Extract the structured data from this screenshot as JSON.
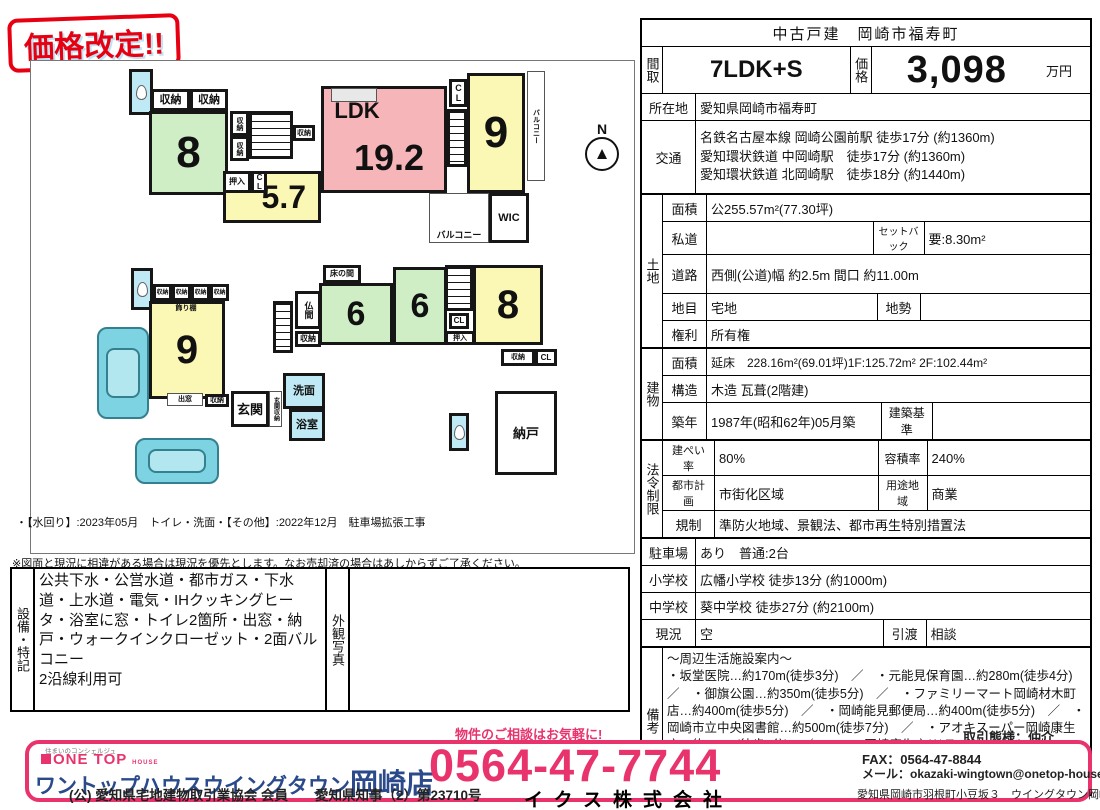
{
  "badge": {
    "label": "価格改定!!"
  },
  "notes": {
    "renovation": "・【水回り】:2023年05月　トイレ・洗面・【その他】:2022年12月　駐車場拡張工事",
    "disclaimer": "※図面と現況に相違がある場合は現況を優先とします。なお売却済の場合はあしからずご了承ください。"
  },
  "equipment": {
    "section": "設備・特記",
    "text": "公共下水・公営水道・都市ガス・下水道・上水道・電気・IHクッキングヒータ・浴室に窓・トイレ2箇所・出窓・納戸・ウォークインクローゼット・2面バルコニー\n2沿線利用可",
    "photo_label": "外観写真"
  },
  "spec": {
    "title": "中古戸建　岡崎市福寿町",
    "floor_label": "間取",
    "floor": "7LDK+S",
    "price_label": "価格",
    "price": "3,098",
    "price_unit": "万円",
    "location_label": "所在地",
    "location": "愛知県岡崎市福寿町",
    "transport_label": "交通",
    "transport": "名鉄名古屋本線 岡崎公園前駅 徒歩17分 (約1360m)\n愛知環状鉄道 中岡崎駅　徒歩17分 (約1360m)\n愛知環状鉄道 北岡崎駅　徒歩18分 (約1440m)",
    "land": {
      "section": "土地",
      "area_label": "面積",
      "area": "公255.57m²(77.30坪)",
      "shido_label": "私道",
      "shido": "",
      "setback_label": "セットバック",
      "setback": "要:8.30m²",
      "road_label": "道路",
      "road": "西側(公道)幅 約2.5m 間口 約11.00m",
      "chimoku_label": "地目",
      "chimoku": "宅地",
      "chisei_label": "地勢",
      "chisei": "",
      "rights_label": "権利",
      "rights": "所有権"
    },
    "building": {
      "section": "建物",
      "area_label": "面積",
      "area": "延床　228.16m²(69.01坪)1F:125.72m² 2F:102.44m²",
      "structure_label": "構造",
      "structure": "木造 瓦葺(2階建)",
      "built_label": "築年",
      "built": "1987年(昭和62年)05月築",
      "standard_label": "建築基準",
      "standard": ""
    },
    "legal": {
      "section": "法令制限",
      "coverage_label": "建ぺい率",
      "coverage": "80%",
      "far_label": "容積率",
      "far": "240%",
      "planning_label": "都市計画",
      "planning": "市街化区域",
      "zone_label": "用途地域",
      "zone": "商業",
      "regulation_label": "規制",
      "regulation": "準防火地域、景観法、都市再生特別措置法"
    },
    "parking_label": "駐車場",
    "parking": "あり　普通:2台",
    "elementary_label": "小学校",
    "elementary": "広幡小学校 徒歩13分 (約1000m)",
    "junior_label": "中学校",
    "junior": "葵中学校 徒歩27分 (約2100m)",
    "status_label": "現況",
    "status": "空",
    "handover_label": "引渡",
    "handover": "相談",
    "remarks_label": "備考",
    "remarks": "～周辺生活施設案内～\n・坂堂医院…約170m(徒歩3分)　／　・元能見保育園…約280m(徒歩4分)　／　・御旗公園…約350m(徒歩5分)　／　・ファミリーマート岡崎材木町店…約400m(徒歩5分)　／　・岡崎能見郵便局…約400m(徒歩5分)　／　・岡崎市立中央図書館…約500m(徒歩7分)　／　・アオキスーパー岡崎康生店…約700m(徒歩9分)　／　・B&D岡崎康生店(ドラッグストア)…約700m(徒歩9分)　／　・岡崎市民会館…約1000m(徒歩13分)　／　・岡崎市役所…約1800m(徒歩23分)"
  },
  "footer": {
    "tagline": "住まいのコンシェルジュ",
    "brand": "ONE TOP",
    "brand_sub": "HOUSE",
    "store": "ワントップハウスウイングタウン",
    "store_suffix": "岡崎店",
    "license": "(公) 愛知県宅地建物取引業協会 会員　　愛知県知事（2）第23710号",
    "cta": "物件のご相談はお気軽に!",
    "phone": "0564-47-7744",
    "company": "イクス株式会社",
    "deal_type": "取引態様：仲介",
    "fax": "FAX：0564-47-8844",
    "email": "メール：okazaki-wingtown@onetop-house.jp",
    "address": "愛知県岡崎市羽根町小豆坂３　ウイングタウン岡崎１F"
  },
  "floorplan": {
    "compass": "N",
    "rooms": [
      {
        "name": "toilet-room-2f",
        "label": "",
        "x": 128,
        "y": 68,
        "w": 24,
        "h": 46,
        "bg": "#bfe9f4",
        "cls": "toilet"
      },
      {
        "name": "closet-2f-a",
        "label": "収納",
        "x": 150,
        "y": 88,
        "w": 39,
        "h": 22,
        "fs": 11
      },
      {
        "name": "closet-2f-b",
        "label": "収納",
        "x": 189,
        "y": 88,
        "w": 38,
        "h": 22,
        "fs": 11
      },
      {
        "name": "room-8-2f",
        "label": "8",
        "x": 148,
        "y": 110,
        "w": 79,
        "h": 84,
        "bg": "#cfeec6",
        "fs": 44,
        "cls": "tatami"
      },
      {
        "name": "stairs-2f",
        "label": "",
        "x": 248,
        "y": 110,
        "w": 44,
        "h": 48,
        "cls": "stairs-v"
      },
      {
        "name": "closet-2f-c",
        "label": "収納",
        "x": 229,
        "y": 110,
        "w": 19,
        "h": 25,
        "fs": 7,
        "cls": "vert"
      },
      {
        "name": "closet-2f-d",
        "label": "収納",
        "x": 229,
        "y": 135,
        "w": 19,
        "h": 25,
        "fs": 7,
        "cls": "vert"
      },
      {
        "name": "closet-2f-e",
        "label": "収納",
        "x": 292,
        "y": 124,
        "w": 22,
        "h": 16,
        "fs": 7
      },
      {
        "name": "room-5-7",
        "label": "5.7",
        "x": 222,
        "y": 170,
        "w": 98,
        "h": 52,
        "bg": "#fbf7b4",
        "fs": 32,
        "cls": "label-right"
      },
      {
        "name": "oshiire-2f",
        "label": "押入",
        "x": 222,
        "y": 170,
        "w": 28,
        "h": 22,
        "fs": 8
      },
      {
        "name": "closet-cl-2f-a",
        "label": "CL",
        "x": 250,
        "y": 170,
        "w": 16,
        "h": 22,
        "fs": 8,
        "cls": "vert"
      },
      {
        "name": "ldk-room",
        "label": "",
        "x": 320,
        "y": 85,
        "w": 126,
        "h": 107,
        "bg": "#f6b5b8"
      },
      {
        "name": "kitchen-counter",
        "label": "",
        "x": 330,
        "y": 87,
        "w": 46,
        "h": 14,
        "bg": "#e8e8e8",
        "cls": "thin"
      },
      {
        "name": "ldk-label",
        "label": "LDK",
        "x": 324,
        "y": 96,
        "w": 64,
        "h": 28,
        "fs": 22,
        "cls": "noborder"
      },
      {
        "name": "ldk-size-label",
        "label": "19.2",
        "x": 342,
        "y": 136,
        "w": 92,
        "h": 42,
        "fs": 36,
        "cls": "noborder"
      },
      {
        "name": "stairs-2f-mid",
        "label": "",
        "x": 446,
        "y": 108,
        "w": 20,
        "h": 58,
        "cls": "stairs-v"
      },
      {
        "name": "closet-cl-2f-b",
        "label": "CL",
        "x": 448,
        "y": 78,
        "w": 18,
        "h": 28,
        "fs": 9,
        "cls": "vert"
      },
      {
        "name": "room-9-2f",
        "label": "9",
        "x": 466,
        "y": 72,
        "w": 58,
        "h": 120,
        "bg": "#fbf7b4",
        "fs": 44
      },
      {
        "name": "balcony-2f-side",
        "label": "バルコニー",
        "x": 526,
        "y": 70,
        "w": 18,
        "h": 110,
        "fs": 7,
        "cls": "thin vert"
      },
      {
        "name": "balcony-2f-rear",
        "label": "バルコニー",
        "x": 428,
        "y": 192,
        "w": 60,
        "h": 50,
        "fs": 9,
        "cls": "thin label-bottom"
      },
      {
        "name": "wic-room",
        "label": "WIC",
        "x": 488,
        "y": 192,
        "w": 40,
        "h": 50,
        "fs": 11
      },
      {
        "name": "toilet-room-1f",
        "label": "",
        "x": 130,
        "y": 267,
        "w": 22,
        "h": 42,
        "bg": "#bfe9f4",
        "cls": "toilet"
      },
      {
        "name": "closet-1f-a",
        "label": "収納",
        "x": 152,
        "y": 283,
        "w": 19,
        "h": 17,
        "fs": 6
      },
      {
        "name": "closet-1f-b",
        "label": "収納",
        "x": 171,
        "y": 283,
        "w": 19,
        "h": 17,
        "fs": 6
      },
      {
        "name": "closet-1f-c",
        "label": "収納",
        "x": 190,
        "y": 283,
        "w": 19,
        "h": 17,
        "fs": 6
      },
      {
        "name": "closet-1f-d",
        "label": "収納",
        "x": 209,
        "y": 283,
        "w": 19,
        "h": 17,
        "fs": 6
      },
      {
        "name": "room-9-1f",
        "label": "9",
        "x": 148,
        "y": 300,
        "w": 76,
        "h": 98,
        "bg": "#fbf7b4",
        "fs": 40,
        "cls": "tatami"
      },
      {
        "name": "kazaridana-label",
        "label": "飾り棚",
        "x": 160,
        "y": 301,
        "w": 50,
        "h": 12,
        "fs": 7,
        "cls": "noborder"
      },
      {
        "name": "demado-label",
        "label": "出窓",
        "x": 166,
        "y": 392,
        "w": 36,
        "h": 13,
        "fs": 7,
        "cls": "thin"
      },
      {
        "name": "closet-1f-e",
        "label": "収納",
        "x": 204,
        "y": 393,
        "w": 24,
        "h": 13,
        "fs": 7
      },
      {
        "name": "genkan-room",
        "label": "玄関",
        "x": 230,
        "y": 390,
        "w": 38,
        "h": 36,
        "fs": 13
      },
      {
        "name": "genkan-storage",
        "label": "玄関収納",
        "x": 268,
        "y": 390,
        "w": 13,
        "h": 36,
        "fs": 6,
        "cls": "vert thin"
      },
      {
        "name": "stairs-1f",
        "label": "",
        "x": 272,
        "y": 300,
        "w": 20,
        "h": 52,
        "cls": "stairs-v"
      },
      {
        "name": "butsuma-room",
        "label": "仏間",
        "x": 294,
        "y": 290,
        "w": 26,
        "h": 38,
        "fs": 9,
        "cls": "vert"
      },
      {
        "name": "closet-1f-f",
        "label": "収納",
        "x": 294,
        "y": 330,
        "w": 26,
        "h": 16,
        "fs": 8
      },
      {
        "name": "tokonoma",
        "label": "床の間",
        "x": 322,
        "y": 264,
        "w": 38,
        "h": 18,
        "fs": 8
      },
      {
        "name": "room-6-a",
        "label": "6",
        "x": 318,
        "y": 282,
        "w": 74,
        "h": 62,
        "bg": "#cfeec6",
        "fs": 34,
        "cls": "tatami"
      },
      {
        "name": "room-6-b",
        "label": "6",
        "x": 392,
        "y": 266,
        "w": 54,
        "h": 78,
        "bg": "#cfeec6",
        "fs": 34,
        "cls": "tatami"
      },
      {
        "name": "stairs-1f-b",
        "label": "",
        "x": 444,
        "y": 264,
        "w": 28,
        "h": 46,
        "cls": "stairs-v"
      },
      {
        "name": "closet-cl-1f-a",
        "label": "CL",
        "x": 448,
        "y": 312,
        "w": 20,
        "h": 16,
        "fs": 8
      },
      {
        "name": "oshiire-1f",
        "label": "押入",
        "x": 444,
        "y": 330,
        "w": 30,
        "h": 14,
        "fs": 7
      },
      {
        "name": "room-8-1f",
        "label": "8",
        "x": 472,
        "y": 264,
        "w": 70,
        "h": 80,
        "bg": "#fbf7b4",
        "fs": 40
      },
      {
        "name": "closet-1f-g",
        "label": "収納",
        "x": 500,
        "y": 348,
        "w": 34,
        "h": 17,
        "fs": 7
      },
      {
        "name": "closet-cl-1f-b",
        "label": "CL",
        "x": 534,
        "y": 348,
        "w": 22,
        "h": 17,
        "fs": 8
      },
      {
        "name": "nando-room",
        "label": "納戸",
        "x": 494,
        "y": 390,
        "w": 62,
        "h": 84,
        "fs": 13
      },
      {
        "name": "toilet-room-1f-b",
        "label": "",
        "x": 448,
        "y": 412,
        "w": 20,
        "h": 38,
        "bg": "#bfe9f4",
        "cls": "toilet"
      },
      {
        "name": "senmen-room",
        "label": "洗面",
        "x": 282,
        "y": 372,
        "w": 42,
        "h": 36,
        "bg": "#bfe9f4",
        "fs": 11
      },
      {
        "name": "bath-room",
        "label": "浴室",
        "x": 288,
        "y": 408,
        "w": 36,
        "h": 32,
        "bg": "#bfe9f4",
        "fs": 11
      },
      {
        "name": "car-1",
        "label": "",
        "x": 96,
        "y": 326,
        "w": 52,
        "h": 92,
        "bg": "#7ed3e2",
        "cls": "car"
      },
      {
        "name": "car-2",
        "label": "",
        "x": 134,
        "y": 437,
        "w": 84,
        "h": 46,
        "bg": "#7ed3e2",
        "cls": "car"
      }
    ]
  },
  "colors": {
    "accent_pink": "#e8336d",
    "badge_red": "#e60012",
    "room_pink": "#f6b5b8",
    "room_yellow": "#fbf7b4",
    "room_green": "#cfeec6",
    "wet_blue": "#bfe9f4"
  }
}
